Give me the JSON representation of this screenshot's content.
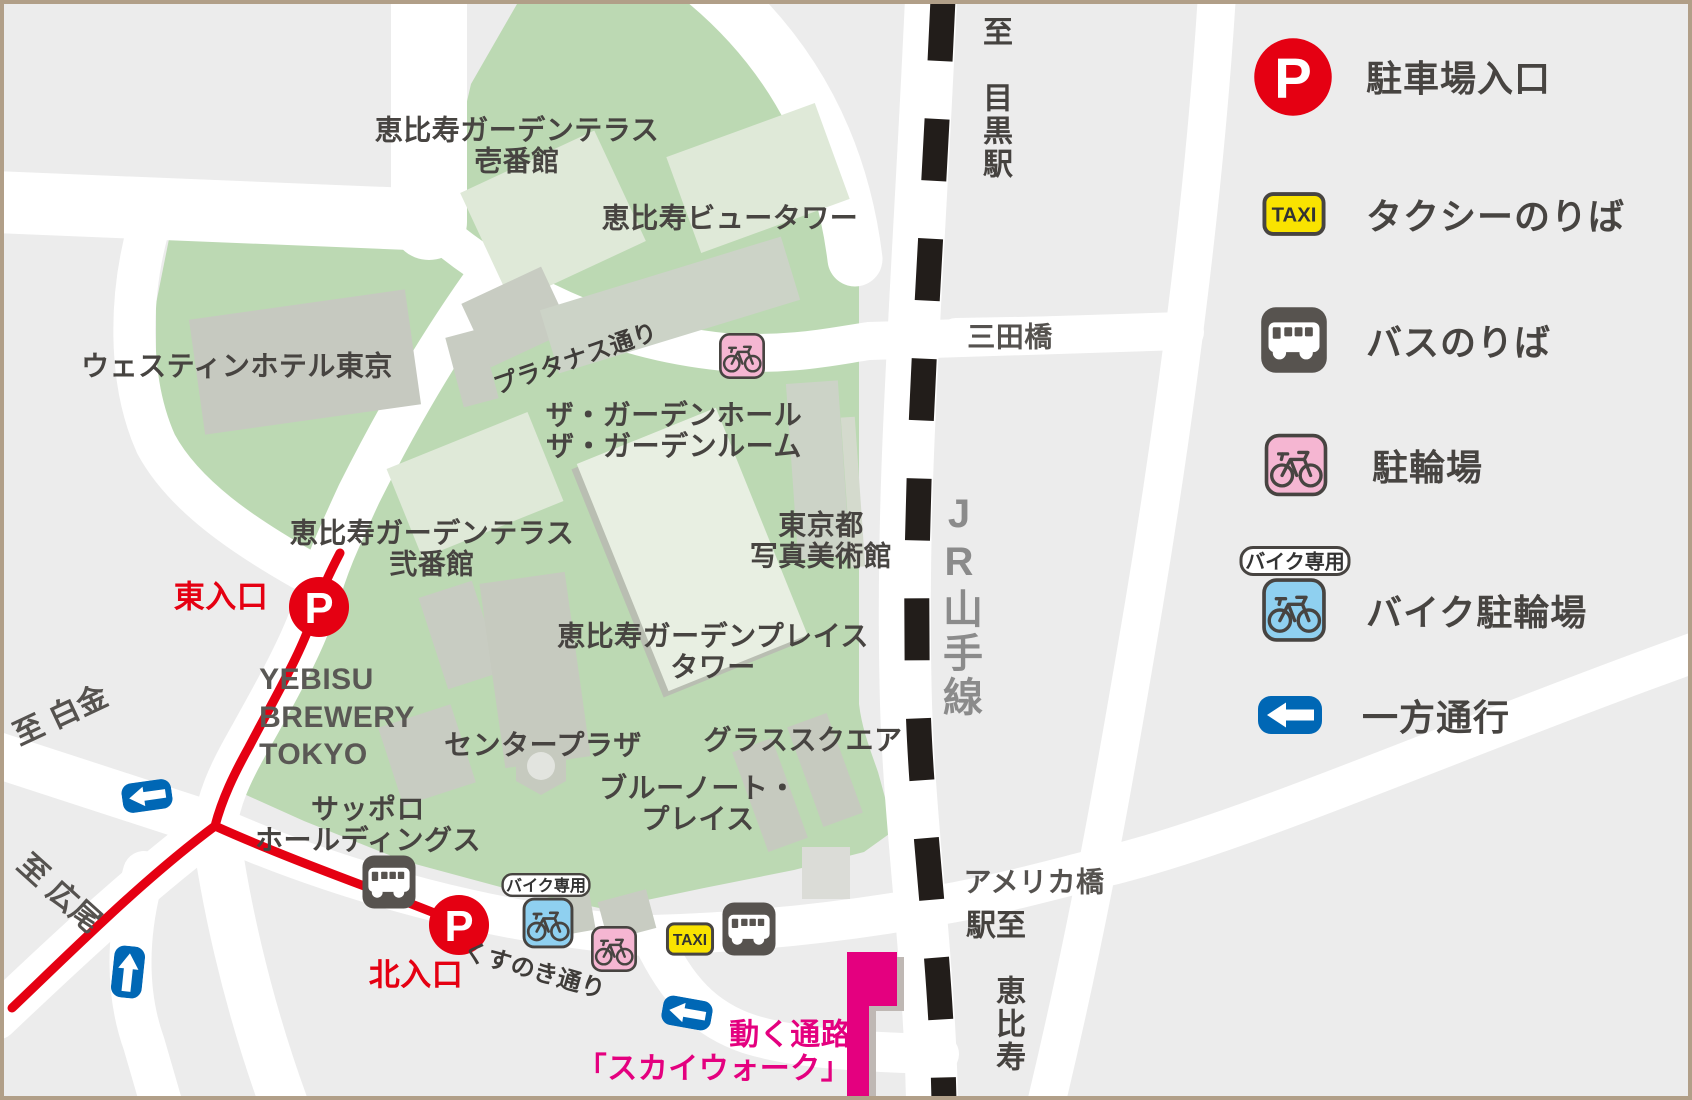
{
  "labels": {
    "terrace1": "恵比寿ガーデンテラス\n壱番館",
    "view_tower": "恵比寿ビュータワー",
    "westin": "ウェスティンホテル東京",
    "garden_hall": "ザ・ガーデンホール\nザ・ガーデンルーム",
    "terrace2": "恵比寿ガーデンテラス\n弐番館",
    "museum": "東京都\n写真美術館",
    "gp_tower": "恵比寿ガーデンプレイス\nタワー",
    "center_plaza": "センタープラザ",
    "glass_square": "グラススクエア",
    "blue_note": "ブルーノート・\nプレイス",
    "sapporo": "サッポロ\nホールディングス",
    "yebisu_brewery": "YEBISU\nBREWERY\nTOKYO",
    "platanus_st": "プラタナス通り",
    "kusunoki_st": "くすのき通り",
    "mita_bridge": "三田橋",
    "america_bridge": "アメリカ橋",
    "to_shirokane": "至 白金",
    "to_hiroo": "至 広尾",
    "to_meguro": "至　目黒駅",
    "to_ebisu": "至　恵比寿駅",
    "jr_line": "JR山手線",
    "east_entrance": "東入口",
    "north_entrance": "北入口",
    "skywalk": "動く通路\n「スカイウォーク」"
  },
  "icons": {
    "parking_letter": "P",
    "taxi_text": "TAXI",
    "bike_only_badge": "バイク専用"
  },
  "legend": {
    "parking": "駐車場入口",
    "taxi": "タクシーのりば",
    "bus": "バスのりば",
    "bicycle": "駐輪場",
    "motorbike": "バイク駐輪場",
    "oneway": "一方通行"
  },
  "colors": {
    "background": "#ececec",
    "park_green": "#bcd9b3",
    "road_white": "#ffffff",
    "route_red": "#e50012",
    "rail_black": "#221d1a",
    "skywalk_magenta": "#e4007f",
    "oneway_blue": "#0067b5",
    "taxi_yellow": "#f9e300",
    "bus_dark": "#57534f",
    "bicycle_pink": "#f5b6d2",
    "motorbike_blue": "#8fd0f0",
    "frame_tan": "#b19f88"
  }
}
